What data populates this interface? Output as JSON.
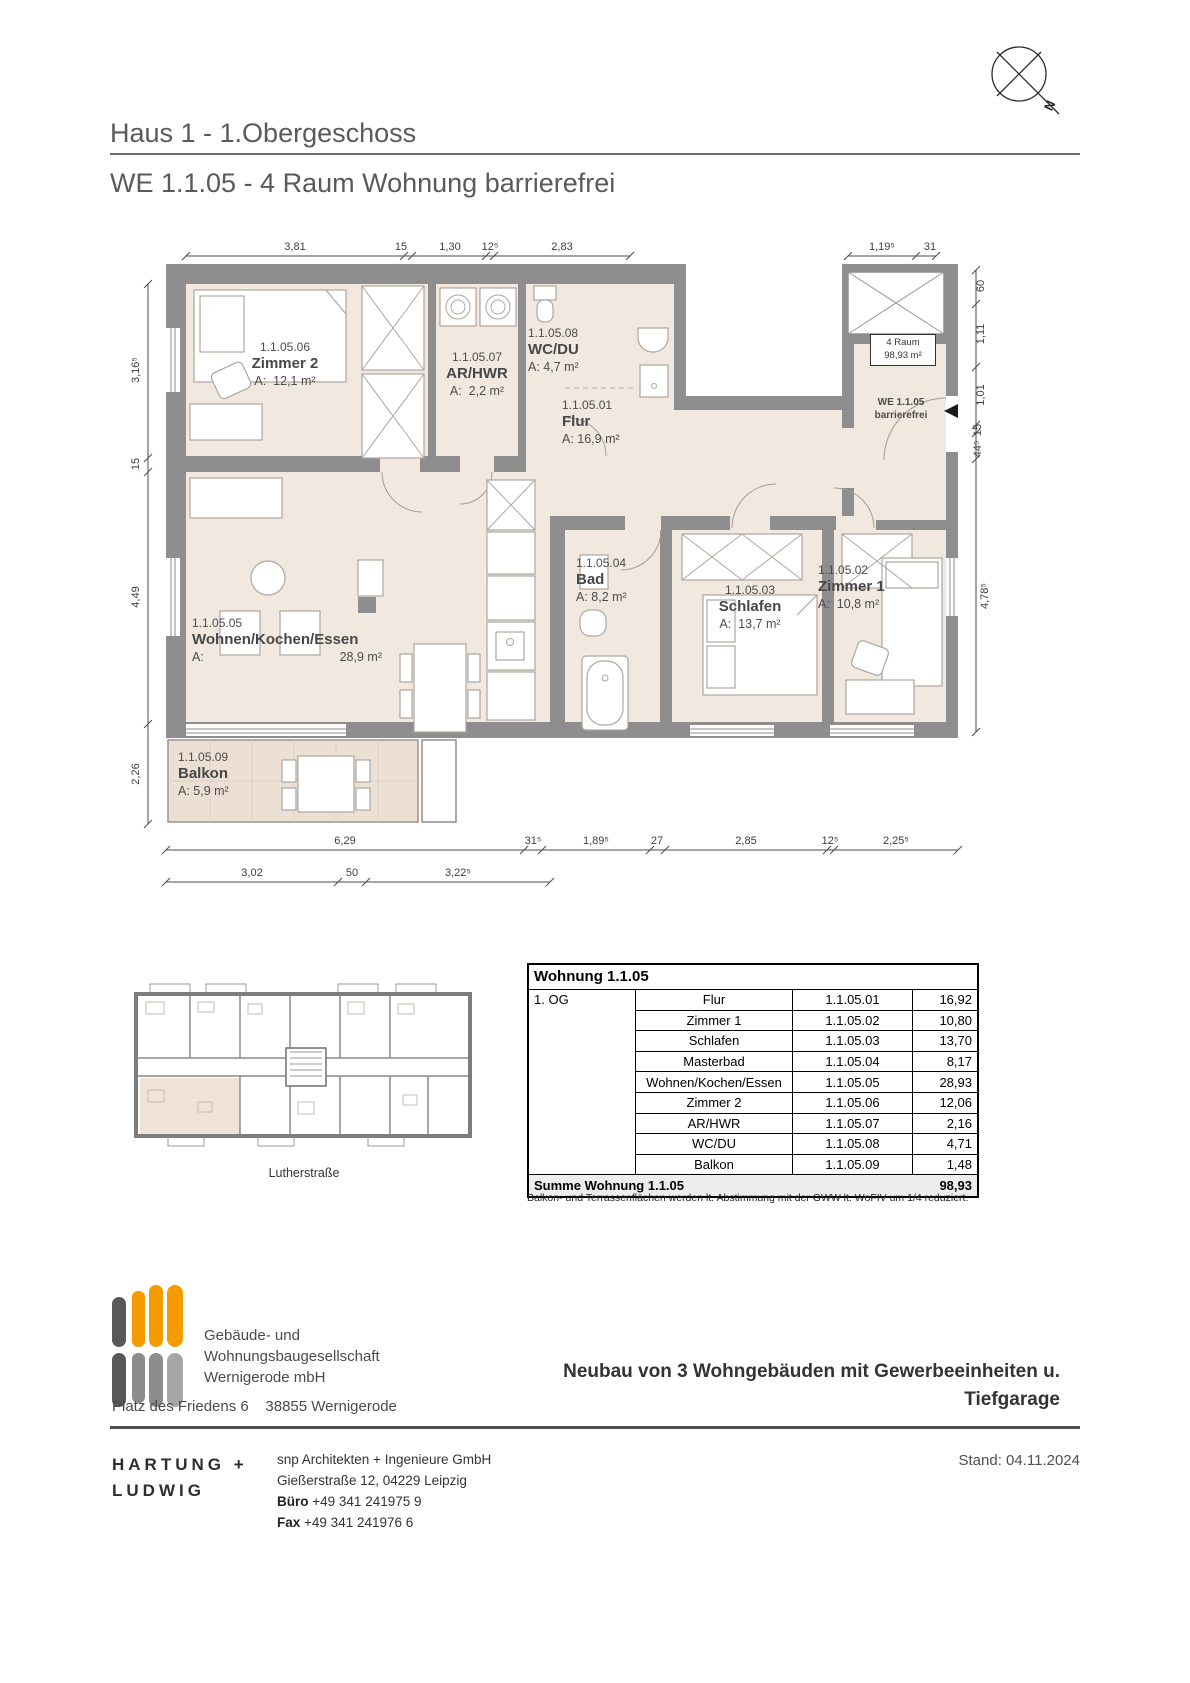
{
  "header": {
    "project_line": "Haus 1 - 1.Obergeschoss",
    "unit_line": "WE 1.1.05 - 4 Raum Wohnung barrierefrei"
  },
  "north_label": "N",
  "plan": {
    "rooms": [
      {
        "id": "1.1.05.01",
        "name": "Flur",
        "area": "A: 16,9 m²"
      },
      {
        "id": "1.1.05.02",
        "name": "Zimmer 1",
        "area": "A:  10,8 m²"
      },
      {
        "id": "1.1.05.03",
        "name": "Schlafen",
        "area": "A:  13,7 m²"
      },
      {
        "id": "1.1.05.04",
        "name": "Bad",
        "area": "A: 8,2 m²"
      },
      {
        "id": "1.1.05.05",
        "name": "Wohnen/Kochen/Essen",
        "area_prefix": "A:",
        "area_value": "28,9 m²"
      },
      {
        "id": "1.1.05.06",
        "name": "Zimmer 2",
        "area": "A:  12,1 m²"
      },
      {
        "id": "1.1.05.07",
        "name": "AR/HWR",
        "area": "A:  2,2 m²"
      },
      {
        "id": "1.1.05.08",
        "name": "WC/DU",
        "area": "A: 4,7 m²"
      },
      {
        "id": "1.1.05.09",
        "name": "Balkon",
        "area": "A: 5,9 m²"
      }
    ],
    "unit_box": {
      "line1": "4 Raum",
      "line2": "98,93 m²"
    },
    "entrance": {
      "line1": "WE 1.1.05",
      "line2": "barrierefrei"
    },
    "dims_top": [
      "3,81",
      "15",
      "1,30",
      "12⁵",
      "2,83",
      "1,19⁵",
      "31"
    ],
    "dims_left": [
      "3,16⁵",
      "15",
      "4,49",
      "2,26"
    ],
    "dims_right": [
      "60",
      "1,11",
      "1,01",
      "15",
      "44⁵",
      "4,78⁵"
    ],
    "dims_bottom1": [
      "6,29",
      "31⁵",
      "1,89⁵",
      "27",
      "2,85",
      "12⁵",
      "2,25⁵"
    ],
    "dims_bottom2": [
      "3,02",
      "50",
      "3,22⁵"
    ]
  },
  "site_plan": {
    "street_label": "Lutherstraße"
  },
  "table": {
    "title": "Wohnung 1.1.05",
    "floor": "1. OG",
    "rows": [
      [
        "Flur",
        "1.1.05.01",
        "16,92"
      ],
      [
        "Zimmer 1",
        "1.1.05.02",
        "10,80"
      ],
      [
        "Schlafen",
        "1.1.05.03",
        "13,70"
      ],
      [
        "Masterbad",
        "1.1.05.04",
        "8,17"
      ],
      [
        "Wohnen/Kochen/Essen",
        "1.1.05.05",
        "28,93"
      ],
      [
        "Zimmer 2",
        "1.1.05.06",
        "12,06"
      ],
      [
        "AR/HWR",
        "1.1.05.07",
        "2,16"
      ],
      [
        "WC/DU",
        "1.1.05.08",
        "4,71"
      ],
      [
        "Balkon",
        "1.1.05.09",
        "1,48"
      ]
    ],
    "sum_label": "Summe Wohnung 1.1.05",
    "sum_value": "98,93",
    "footnote": "Balkon- und Terrassenflächen werden lt. Abstimmung mit der GWW lt. WoFIV um 1/4 reduziert."
  },
  "footer": {
    "company_line1": "Gebäude- und",
    "company_line2": "Wohnungsbaugesellschaft",
    "company_line3": "Wernigerode mbH",
    "address": "Platz des Friedens 6    38855 Wernigerode",
    "project_title1": "Neubau von 3 Wohngebäuden mit Gewerbeeinheiten u.",
    "project_title2": "Tiefgarage",
    "architect_name1": "HARTUNG +",
    "architect_name2": "LUDWIG",
    "office_line1": "snp Architekten + Ingenieure GmbH",
    "office_line2": "Gießerstraße 12, 04229 Leipzig",
    "phone_label": "Büro",
    "phone_value": "+49 341 241975 9",
    "fax_label": "Fax",
    "fax_value": "+49 341 241976 6",
    "date": "Stand: 04.11.2024"
  },
  "colors": {
    "wall": "#8e8e8e",
    "room_fill": "#f1e8e0",
    "balcony_fill": "#ecdfd4",
    "logo_orange": "#f59b00",
    "logo_gray": "#595959"
  }
}
